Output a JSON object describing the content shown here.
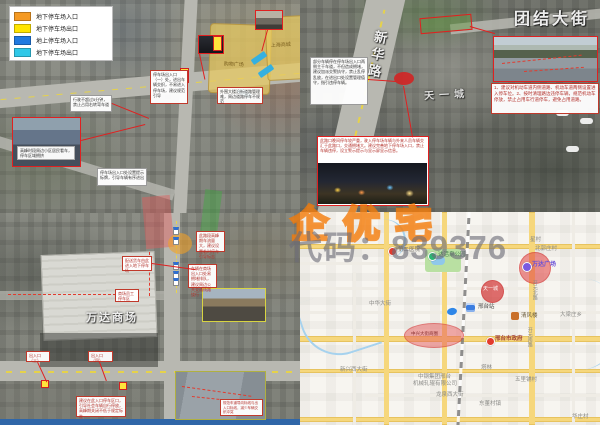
{
  "watermark": {
    "brand": "企优宅",
    "code": "代码：839376",
    "brand_color": "#f37a08",
    "code_color": "#6e6e78"
  },
  "legend": {
    "items": [
      {
        "label": "地下停车场入口",
        "color": "#f59a23"
      },
      {
        "label": "地下停车场出口",
        "color": "#ffe500"
      },
      {
        "label": "地上停车场入口",
        "color": "#2079e0"
      },
      {
        "label": "地下停车场出口",
        "color": "#30c8e8"
      }
    ]
  },
  "tl": {
    "area1_label": "购物广场",
    "area2_label": "上海商城",
    "photo_caption": "高峰时段周边小区居民看车，停车区域拥挤",
    "callout_mid": "停车场出入口（一）处，进出车辆交织，不易进入停车场，建议规范引导",
    "callout_bottom": "行驶不超过5分钟，禁止占用右转弯车道",
    "callout_low": "停车场出入口处设置提示标牌，引导车辆有序进出",
    "callout_right": "外围大楼沿街道路管理难，周边道路停车不规范"
  },
  "tr": {
    "street_title": "团结大街",
    "road_name": "新华路",
    "poi": "天一城",
    "left_note": "部分车辆停在停车场出入口两侧主干车道，不但造成拥堵，建议加派交警执守，禁止乱停乱放，在进出口处设置管理值守，指引违停车辆。",
    "photo_note": "1、建议对机动车道内侧道路、机动车道两侧设置进入停车位。2、按时清理路边违停车辆，规范机动车停放，禁止占用车行道停车，避免占用道路。",
    "night_note": "此路口晚间停车较严重，驶入停车场车辆与外来人员车辆交汇于此路口，交通拥堵大。建议完善地下停车场入口，禁止车辆违停，设立警示提示与显示屏显示信息。"
  },
  "bl": {
    "mall_label": "万达商场",
    "callout_delivery": "配送货车由此进入地下停车场",
    "callout_staff": "商场员工停车区",
    "callout_peak": "此路段高峰期车流量大，建议设置临时停车引导标志",
    "callout_queue": "车辆在商场出入口处易拥堵排队，建议周边公共交通线路绕行",
    "callout_exit3": "出入口（三）",
    "callout_exit4": "出入口（四）",
    "callout_advice": "建议在此入口停车区口，引导社会车辆自行停放，高峰期关闭不低于规定标准",
    "photo_caption": "规范车道导向标线与出入口标线，减少车辆交织冲突"
  },
  "br": {
    "hospital": "第二医院",
    "park": "达活泉公园",
    "xingcun": "星村",
    "beiguozhuang": "北郭庄村",
    "wanda": "万达广场",
    "tianyi": "天一城",
    "kaiyuan_north": "开元北路",
    "station": "邢台站",
    "qingfenglou": "清风楼",
    "zhonghua_st": "中华大街",
    "daliangzhuang": "大梁庄乡",
    "government": "邢台市政府",
    "business_circle": "中兴大街商圈",
    "xinxing_st": "新兴西大街",
    "zhonggang_1": "中钢集团邢台",
    "zhonggang_2": "机械轧辊有限公司",
    "longquan_st": "龙泉西大街",
    "talin": "塔林",
    "wulipu": "五里铺村",
    "dongdong": "东董村镇",
    "huazhuang": "华庄村",
    "kaiyuan_south": "开元南路",
    "circle_color": "#e23c3c",
    "road_color": "#f6d77c"
  }
}
